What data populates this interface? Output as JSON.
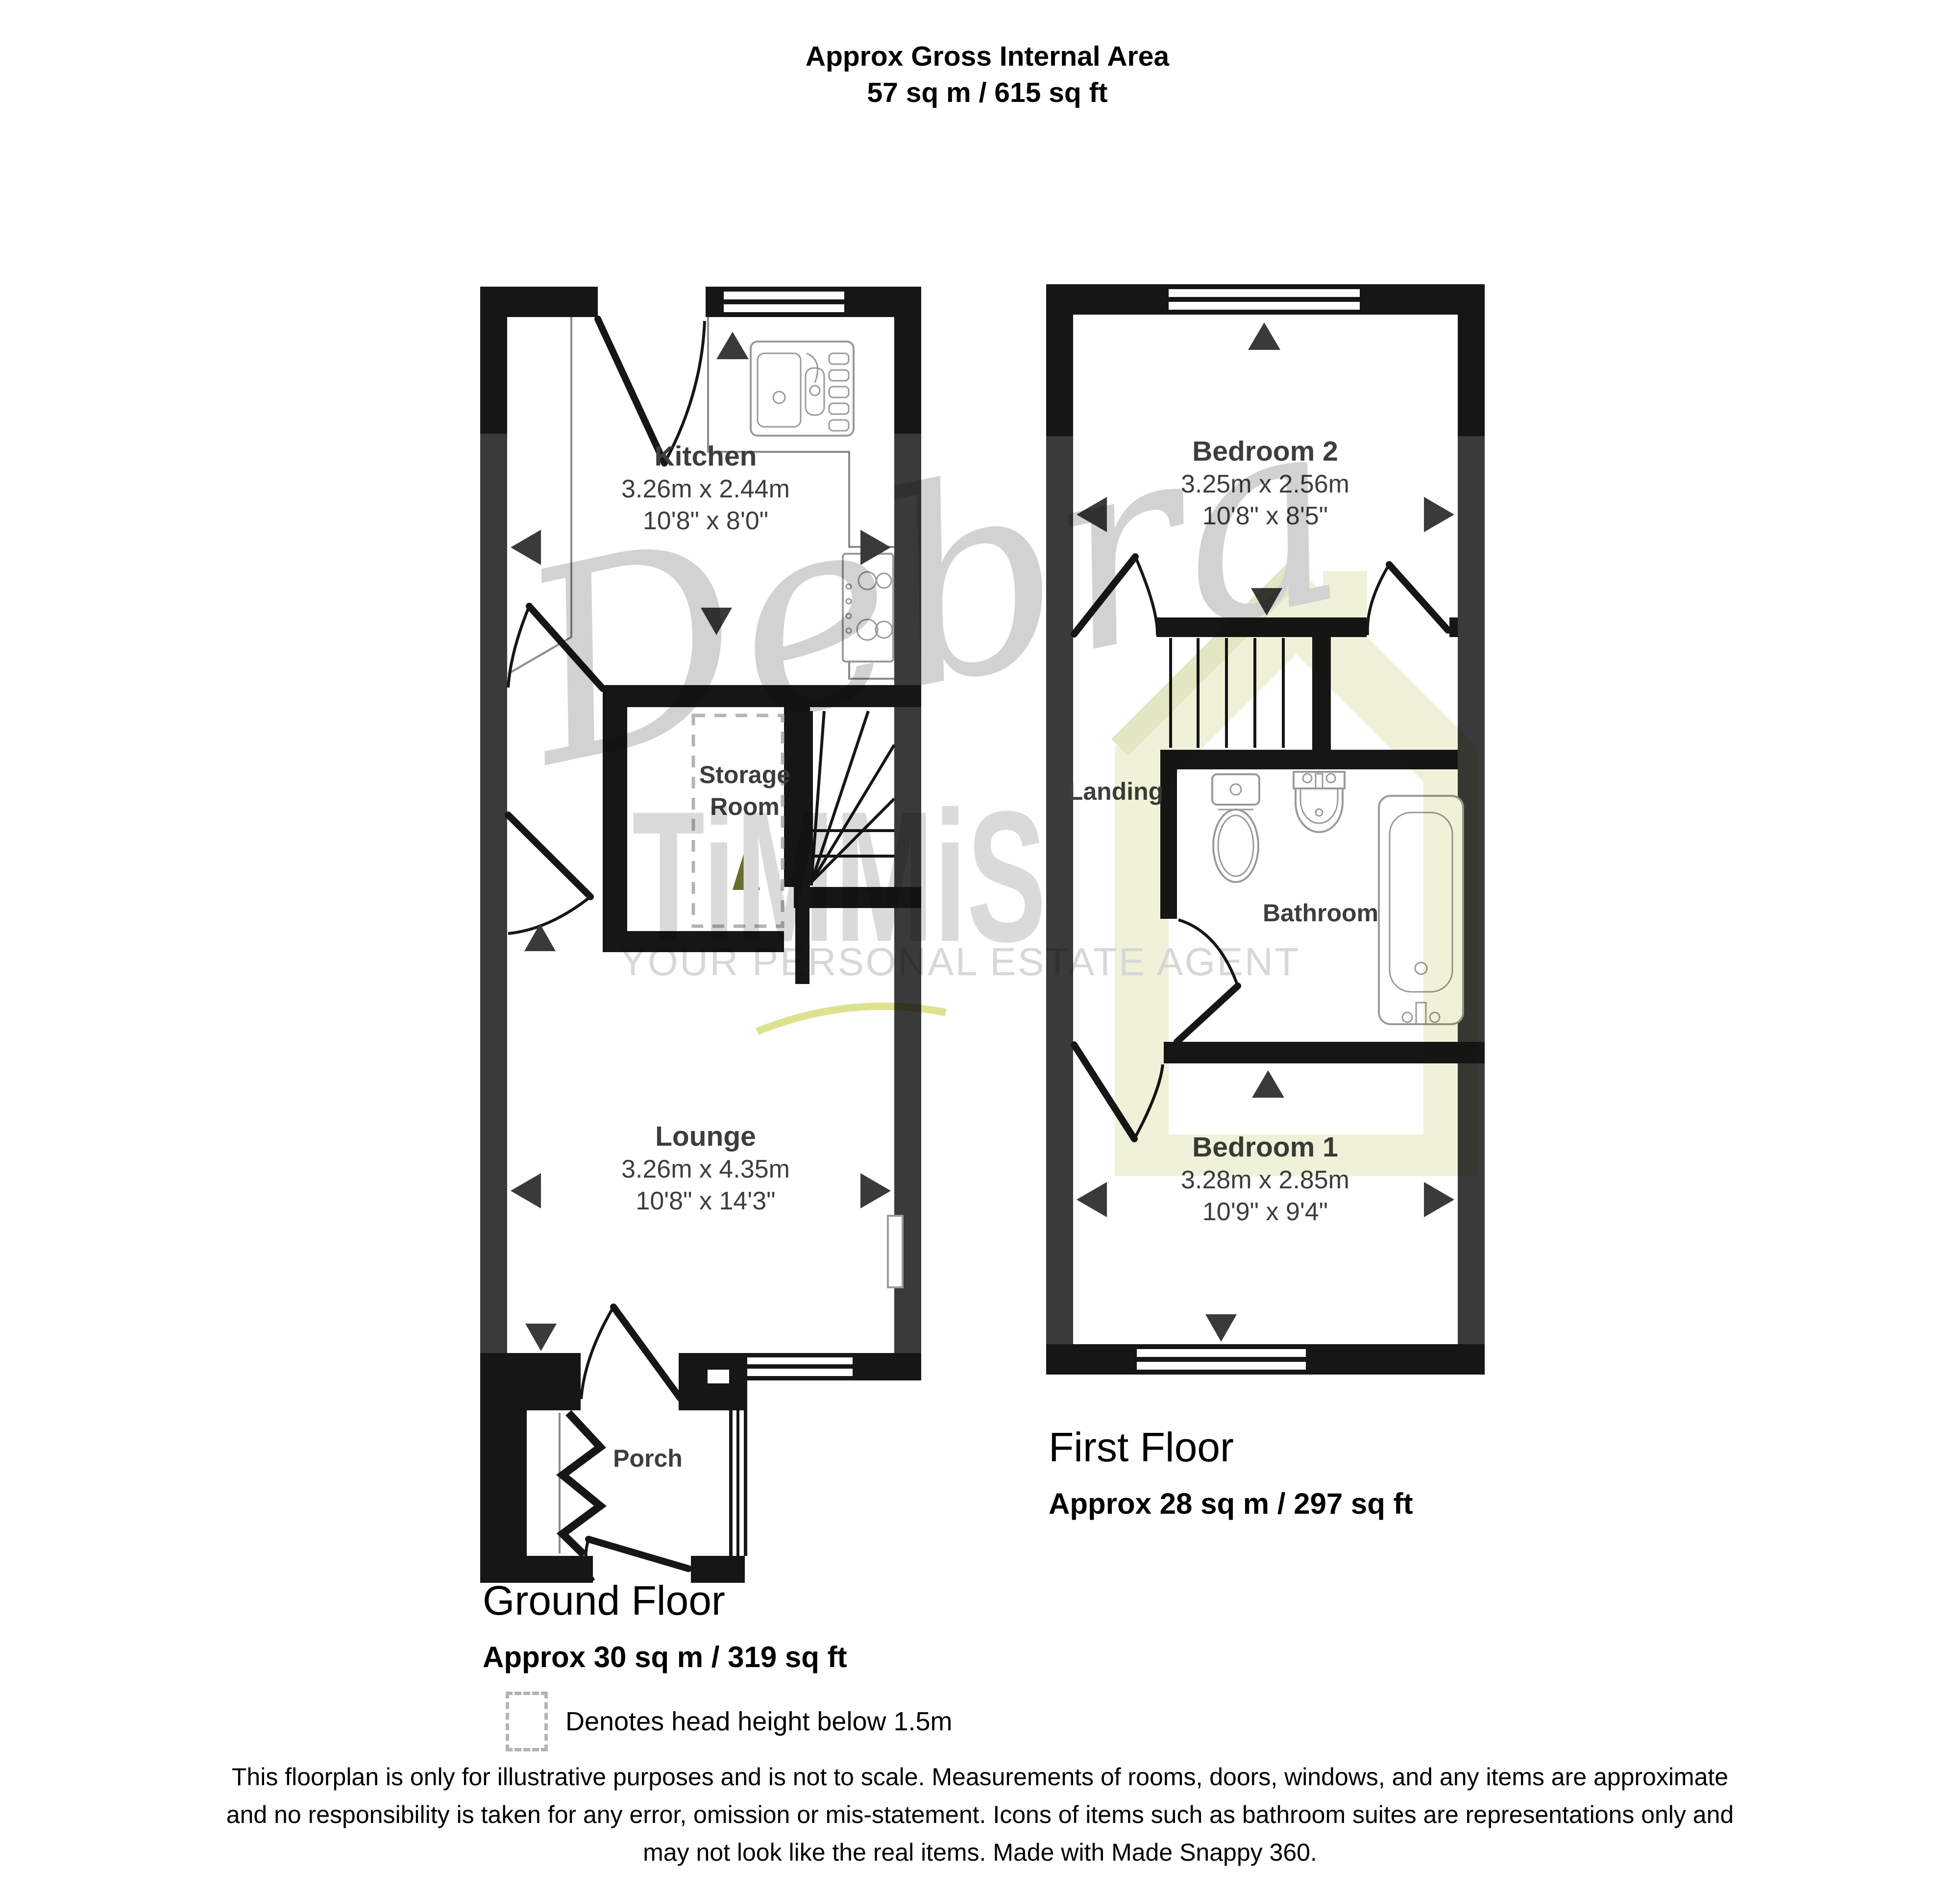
{
  "title": {
    "line1": "Approx Gross Internal Area",
    "line2": "57 sq m / 615 sq ft"
  },
  "ground_floor": {
    "heading": "Ground Floor",
    "area": "Approx 30 sq m / 319 sq ft",
    "kitchen": {
      "name": "Kitchen",
      "metric": "3.26m x 2.44m",
      "imperial": "10'8\" x 8'0\""
    },
    "storage": {
      "name_line1": "Storage",
      "name_line2": "Room"
    },
    "lounge": {
      "name": "Lounge",
      "metric": "3.26m x 4.35m",
      "imperial": "10'8\" x 14'3\""
    },
    "porch": {
      "name": "Porch"
    }
  },
  "first_floor": {
    "heading": "First Floor",
    "area": "Approx 28 sq m / 297 sq ft",
    "bedroom2": {
      "name": "Bedroom 2",
      "metric": "3.25m x 2.56m",
      "imperial": "10'8\" x 8'5\""
    },
    "landing": {
      "name": "Landing"
    },
    "bathroom": {
      "name": "Bathroom"
    },
    "bedroom1": {
      "name": "Bedroom 1",
      "metric": "3.28m x 2.85m",
      "imperial": "10'9\" x 9'4\""
    }
  },
  "legend": {
    "text": "Denotes head height below 1.5m"
  },
  "disclaimer": {
    "line1": "This floorplan is only for illustrative purposes and is not to scale. Measurements of rooms, doors, windows, and any items are approximate",
    "line2": "and no responsibility is taken for any error, omission or mis-statement. Icons of items such as bathroom suites are representations only and",
    "line3": "may not look like the real items. Made with Made Snappy 360."
  },
  "watermark": {
    "script": "Debra",
    "brand": "TiMMiS",
    "tagline": "YOUR PERSONAL ESTATE AGENT"
  },
  "colors": {
    "wall": "#161616",
    "side_wall": "#3a3a3a",
    "room_text": "#3d3d3d",
    "fixture": "#9a9a9a",
    "watermark_gray": "#d8d8d8",
    "watermark_yellow": "#eff1d9",
    "accent_olive": "#6a6d2c",
    "swoosh": "#dde28f"
  }
}
